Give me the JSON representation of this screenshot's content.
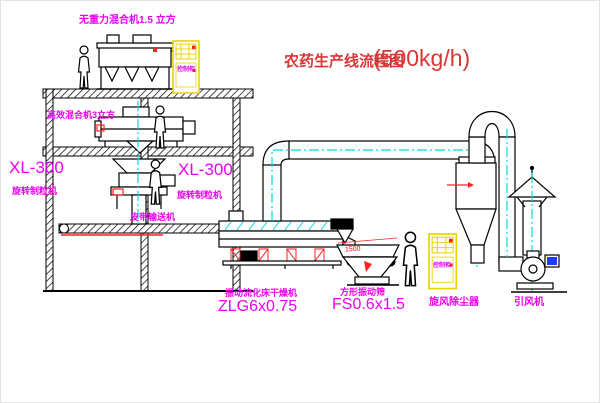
{
  "title": {
    "name": "农药生产线流程图",
    "capacity": "(500kg/h)"
  },
  "equipment_labels": {
    "gravity_mixer": "无重力混合机1.5 立方",
    "high_eff_mixer": "高效混合机3立方",
    "granulator_left_model": "XL-300",
    "granulator_left_name": "旋转制粒机",
    "granulator_right_model": "XL-300",
    "granulator_right_name": "旋转制粒机",
    "belt_conveyor": "皮带输送机",
    "dryer_name": "振动流化床干燥机",
    "dryer_model": "ZLG6x0.75",
    "screen_name": "方形振动筛",
    "screen_model": "FS0.6x1.5",
    "cyclone": "旋风除尘器",
    "fan": "引风机",
    "cabinet": "控制柜"
  },
  "dimensions": {
    "screen_width": "1500"
  },
  "colors": {
    "label_magenta": "#ee00ee",
    "title_red": "#d93636",
    "accent_red": "#ff2020",
    "cad_cyan": "#00dcdc",
    "cabinet_yellow": "#e8d400",
    "line_black": "#000000",
    "motor_blue": "#1e3cff"
  }
}
